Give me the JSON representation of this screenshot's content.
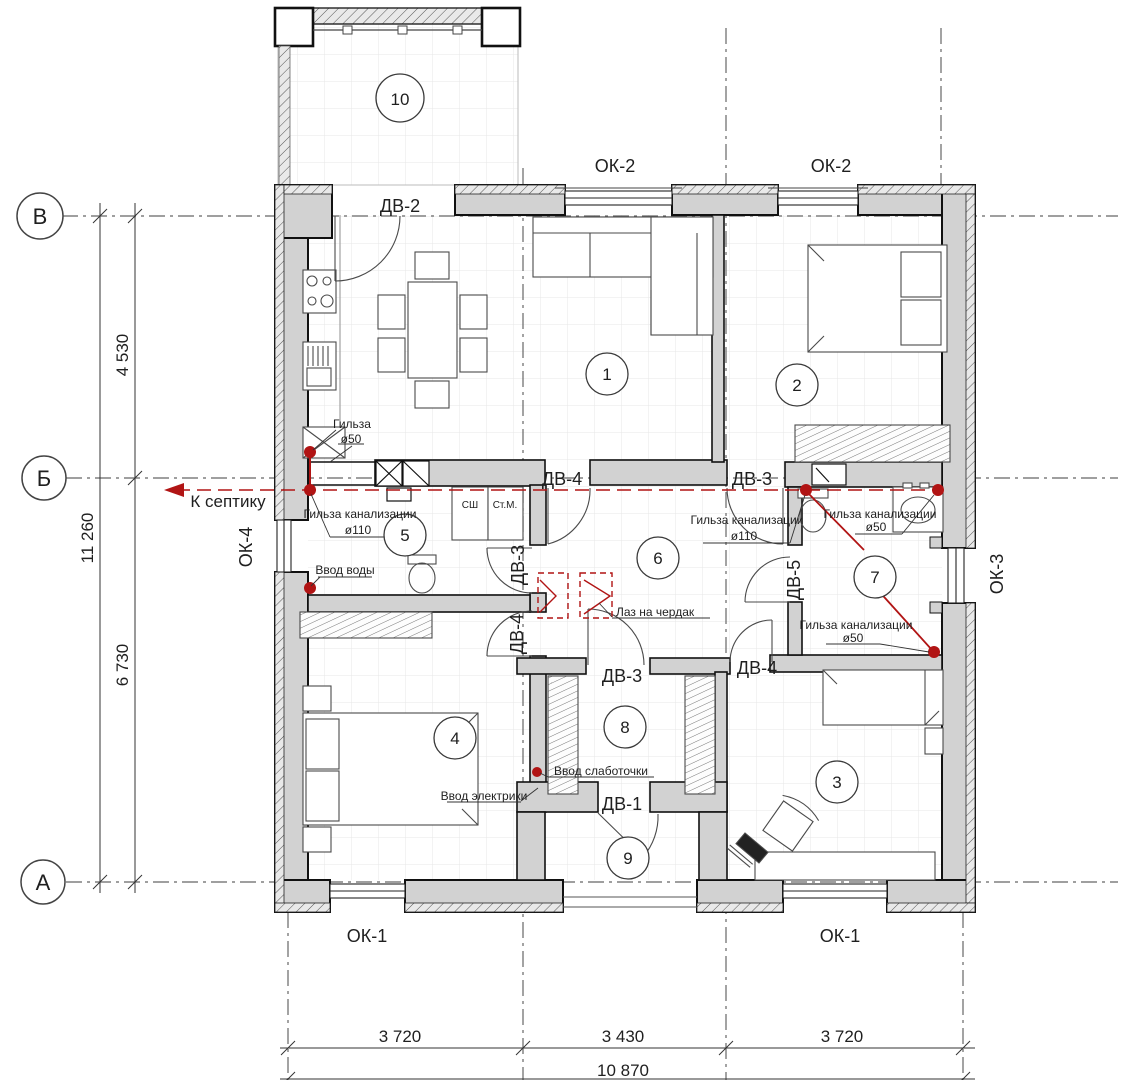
{
  "plan": {
    "title": "floor-plan",
    "axes": {
      "v": "В",
      "b": "Б",
      "a": "А"
    },
    "rooms": {
      "r1": "1",
      "r2": "2",
      "r3": "3",
      "r4": "4",
      "r5": "5",
      "r6": "6",
      "r7": "7",
      "r8": "8",
      "r9": "9",
      "r10": "10"
    },
    "doors": {
      "dv1": "ДВ-1",
      "dv2": "ДВ-2",
      "dv3": "ДВ-3",
      "dv4": "ДВ-4",
      "dv5": "ДВ-5"
    },
    "windows": {
      "ok1": "ОК-1",
      "ok2": "ОК-2",
      "ok3": "ОК-3",
      "ok4": "ОК-4"
    },
    "dims": {
      "d4530": "4 530",
      "d11260": "11 260",
      "d6730": "6 730",
      "d3720": "3 720",
      "d3430": "3 430",
      "d10870": "10 870"
    },
    "notes": {
      "sleeve": "Гильза",
      "d50": "ø50",
      "d110": "ø110",
      "septic": "К септику",
      "sewer": "Гильза канализации",
      "water": "Ввод воды",
      "attic": "Лаз на чердак",
      "lowcurrent": "Ввод слаботочки",
      "electric": "Ввод электрики",
      "sh": "СШ",
      "stm": "Ст.М."
    },
    "colors": {
      "red": "#b11414",
      "wall_fill": "#d2d2d2",
      "line": "#1c1c1c"
    }
  }
}
